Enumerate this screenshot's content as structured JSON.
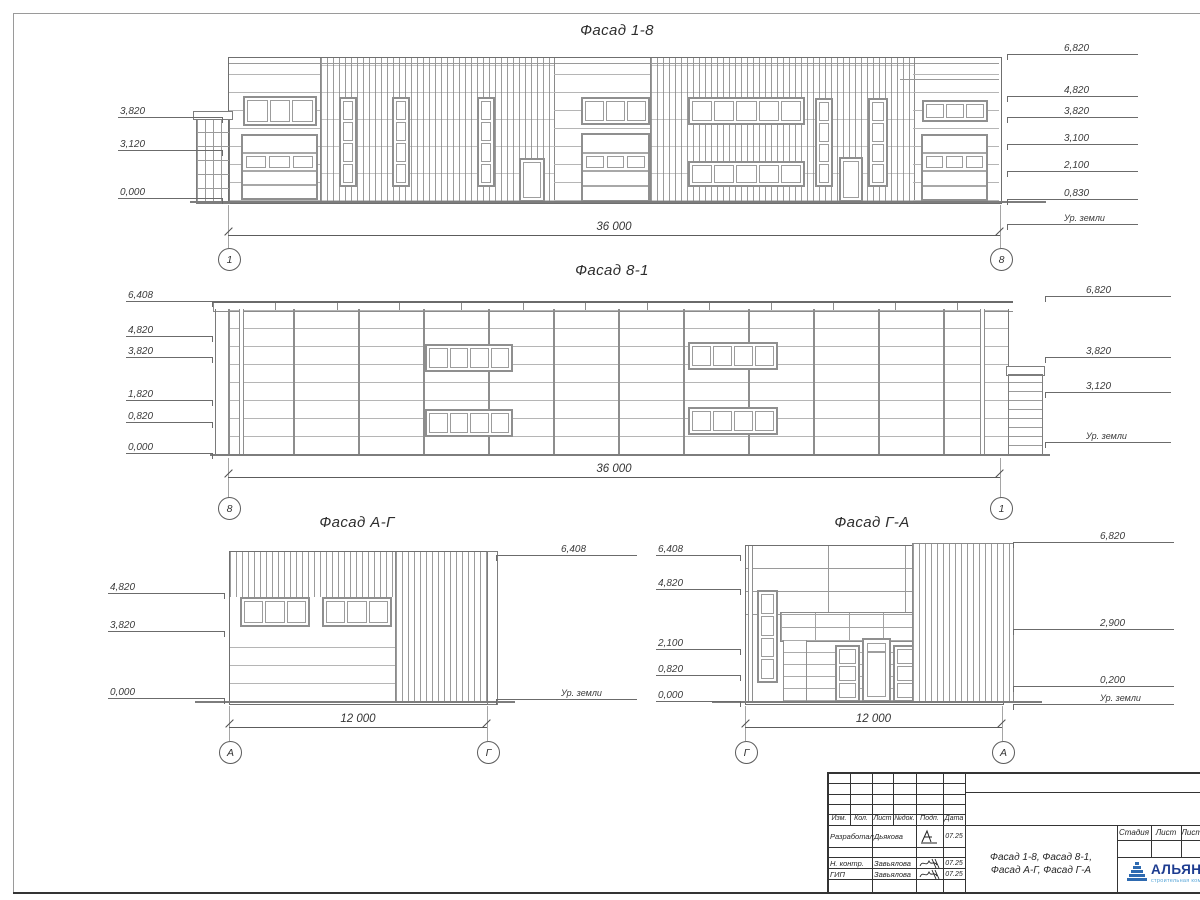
{
  "facades": {
    "f18": {
      "title": "Фасад 1-8",
      "dimension": "36 000",
      "axis_left": "1",
      "axis_right": "8",
      "levels_left": [
        "3,820",
        "3,120",
        "0,000"
      ],
      "levels_right": [
        "6,820",
        "4,820",
        "3,820",
        "3,100",
        "2,100",
        "0,830",
        "Ур. земли"
      ]
    },
    "f81": {
      "title": "Фасад 8-1",
      "dimension": "36 000",
      "axis_left": "8",
      "axis_right": "1",
      "levels_left": [
        "6,408",
        "4,820",
        "3,820",
        "1,820",
        "0,820",
        "0,000"
      ],
      "levels_right": [
        "6,820",
        "3,820",
        "3,120",
        "Ур. земли"
      ]
    },
    "fag": {
      "title": "Фасад А-Г",
      "dimension": "12 000",
      "axis_left": "А",
      "axis_right": "Г",
      "levels_left": [
        "4,820",
        "3,820",
        "0,000"
      ],
      "levels_right": [
        "6,408",
        "Ур. земли"
      ]
    },
    "fga": {
      "title": "Фасад Г-А",
      "dimension": "12 000",
      "axis_left": "Г",
      "axis_right": "А",
      "levels_left": [
        "6,408",
        "4,820",
        "2,100",
        "0,820",
        "0,000"
      ],
      "levels_right": [
        "6,820",
        "2,900",
        "0,200",
        "Ур. земли"
      ]
    }
  },
  "titleblock": {
    "header_cols": [
      "Изм.",
      "Кол.",
      "Лист",
      "№док.",
      "Подп.",
      "Дата"
    ],
    "sign_rows": [
      {
        "role": "Разработал",
        "name": "Дьякова",
        "date": "07.25"
      },
      {
        "role": "Н. контр.",
        "name": "Завьялова",
        "date": "07.25"
      },
      {
        "role": "ГИП",
        "name": "Завьялова",
        "date": "07.25"
      }
    ],
    "doc_title_line1": "Фасад 1-8, Фасад 8-1,",
    "doc_title_line2": "Фасад А-Г, Фасад Г-А",
    "stage_cols": [
      "Стадия",
      "Лист",
      "Листов"
    ],
    "logo": {
      "name": "АЛЬЯНС",
      "tagline": "строительная компания"
    }
  }
}
